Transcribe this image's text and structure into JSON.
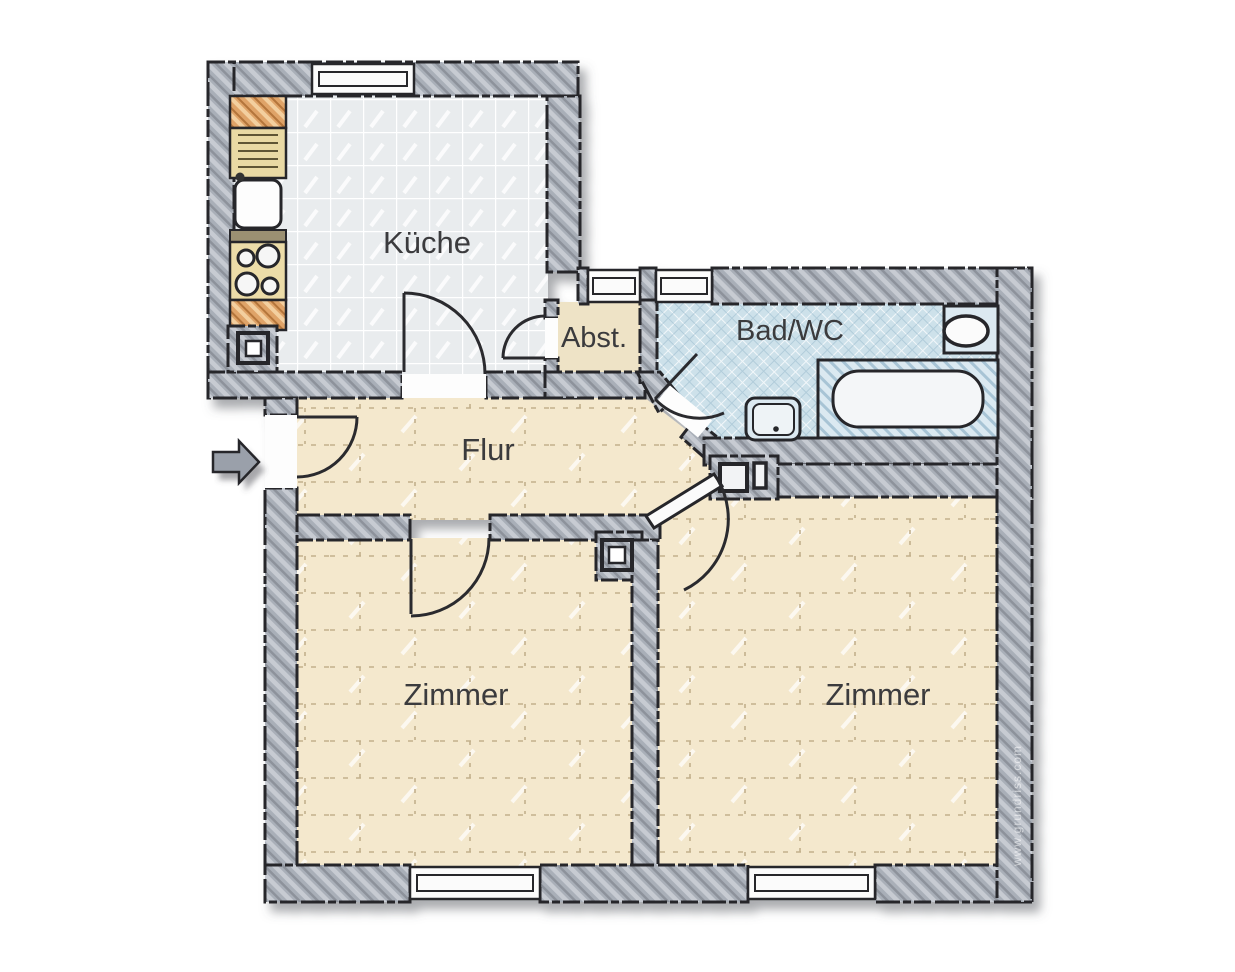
{
  "floorplan": {
    "labels": {
      "kitchen": "Küche",
      "storage": "Abst.",
      "bathroom": "Bad/WC",
      "hallway": "Flur",
      "room_left": "Zimmer",
      "room_right": "Zimmer"
    },
    "watermark": "www.grundriss.com",
    "entrance": {
      "icon": "arrow-right-icon"
    },
    "fixtures": {
      "kitchen": [
        "worktop",
        "drainer",
        "sink",
        "stove-4-burners",
        "shaft"
      ],
      "bathroom": [
        "toilet",
        "bathtub",
        "washbasin"
      ],
      "rooms": [
        "shaft-left-room",
        "shaft-right-room"
      ]
    },
    "window_count": 5,
    "colors": {
      "wall": "#a9afb8",
      "outline": "#26262a",
      "kitchen_floor": "#e9ecee",
      "bath_floor": "#cde1ea",
      "beige_floor": "#f4e8cd",
      "storage_floor": "#eee3c6",
      "wood_counter": "#dfa368",
      "label_text": "#3a3a3d"
    }
  }
}
